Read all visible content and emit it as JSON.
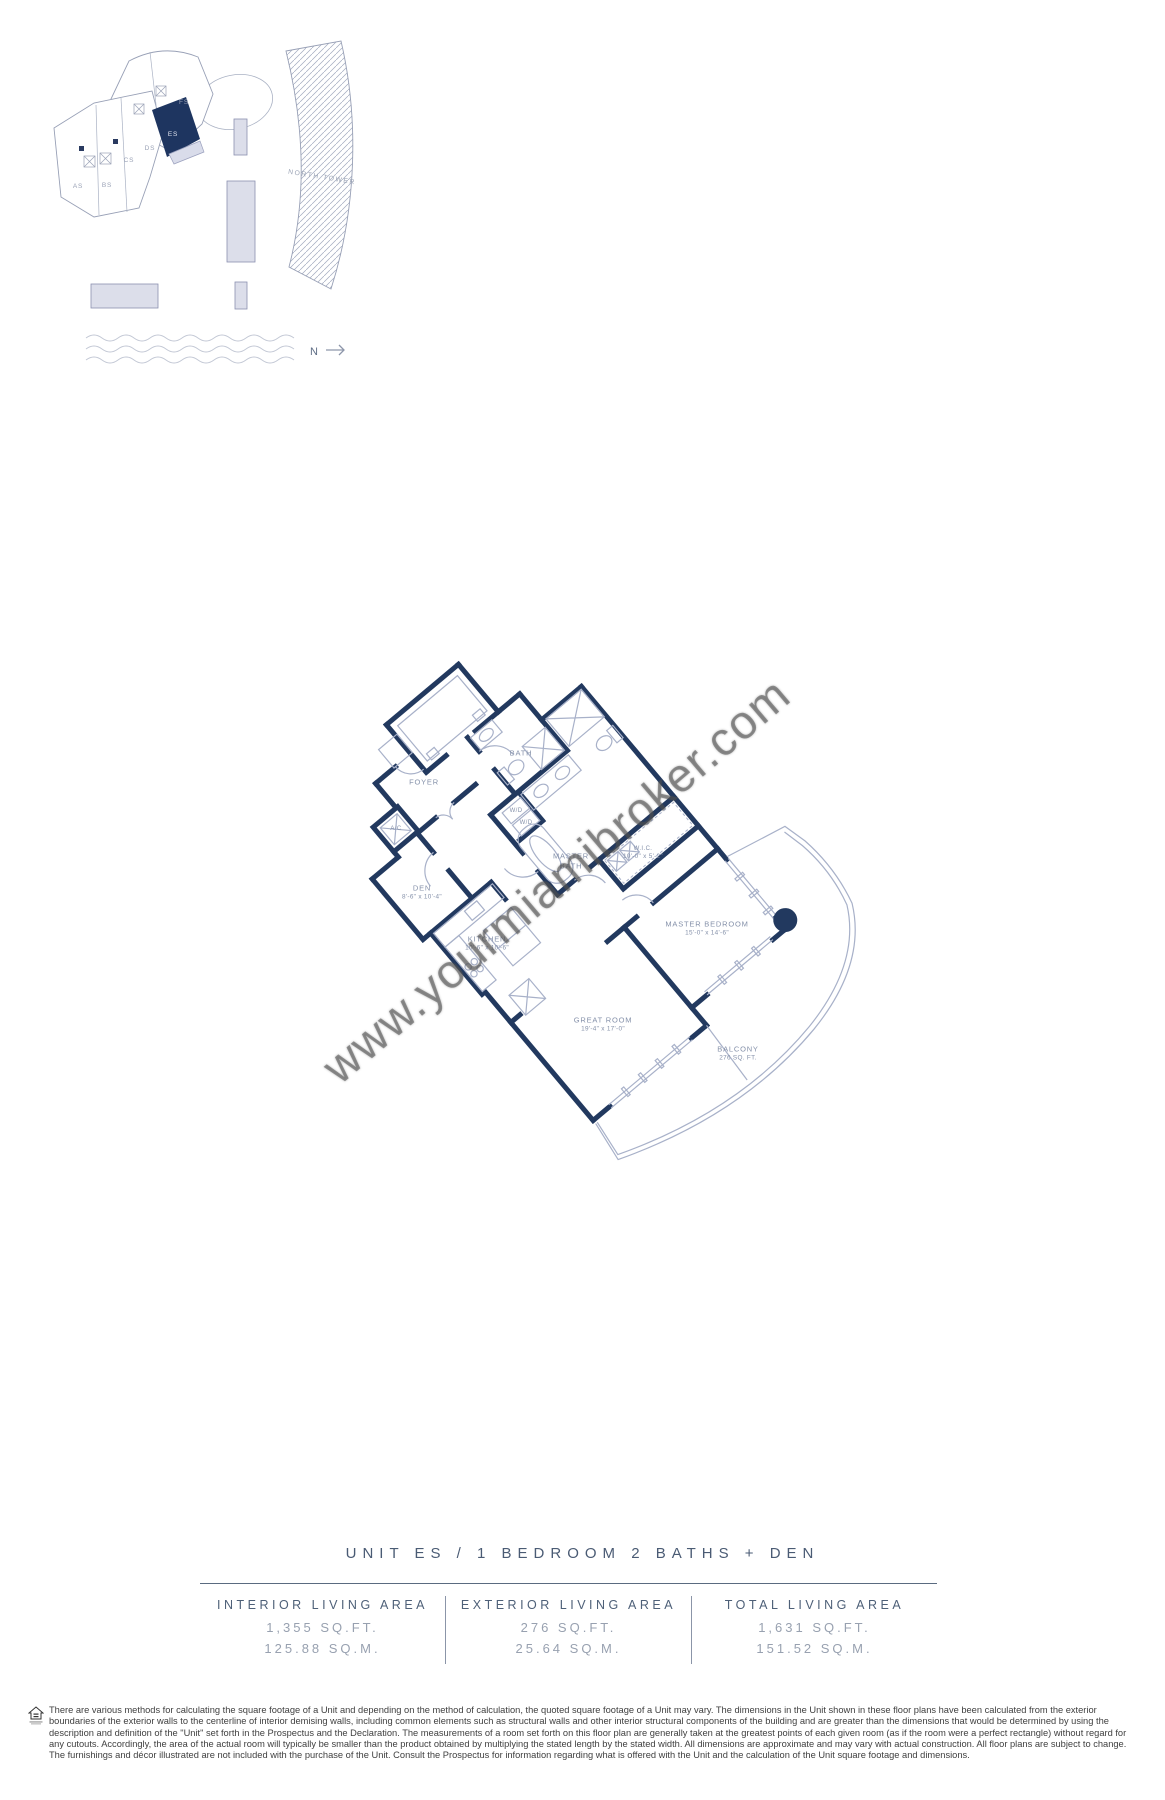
{
  "colors": {
    "wall_navy": "#22395f",
    "highlight_unit_fill": "#1e3560",
    "thin_line": "#a8b1c9",
    "lavender_fill": "#dcdeea",
    "label_gray_blue": "#8490a9",
    "title_color": "#4a5b74",
    "stats_value_color": "#98a1b0"
  },
  "site_plan": {
    "north_tower_label": "NORTH TOWER",
    "north_label": "N",
    "units": [
      {
        "id": "AS"
      },
      {
        "id": "BS"
      },
      {
        "id": "CS"
      },
      {
        "id": "DS"
      },
      {
        "id": "ES",
        "highlighted": true
      },
      {
        "id": "FS"
      }
    ]
  },
  "floor_plan": {
    "labels": [
      {
        "name": "FOYER",
        "dims": ""
      },
      {
        "name": "A/C",
        "dims": ""
      },
      {
        "name": "BATH",
        "dims": ""
      },
      {
        "name": "W/D",
        "dims": ""
      },
      {
        "name": "W/D",
        "dims": ""
      },
      {
        "name": "MASTER BATH",
        "dims": ""
      },
      {
        "name": "W.I.C.",
        "dims": "10'-0\" x 5'-2\""
      },
      {
        "name": "DEN",
        "dims": "8'-6\" x 10'-4\""
      },
      {
        "name": "KITCHEN",
        "dims": "10'-6\" x 10'-6\""
      },
      {
        "name": "MASTER BEDROOM",
        "dims": "15'-0\" x 14'-6\""
      },
      {
        "name": "GREAT ROOM",
        "dims": "19'-4\" x 17'-0\""
      },
      {
        "name": "BALCONY",
        "dims": "276 SQ. FT."
      }
    ]
  },
  "watermark": "www.yourmiamibroker.com",
  "title": "UNIT ES / 1 BEDROOM 2 BATHS + DEN",
  "stats": [
    {
      "label": "INTERIOR LIVING AREA",
      "sqft": "1,355 SQ.FT.",
      "sqm": "125.88 SQ.M."
    },
    {
      "label": "EXTERIOR LIVING AREA",
      "sqft": "276 SQ.FT.",
      "sqm": "25.64 SQ.M."
    },
    {
      "label": "TOTAL LIVING AREA",
      "sqft": "1,631 SQ.FT.",
      "sqm": "151.52 SQ.M."
    }
  ],
  "disclaimer": "There are various methods for calculating the square footage of a Unit and depending on the method of calculation, the quoted square footage of a Unit may vary.  The dimensions in the Unit shown in these floor plans have been calculated from the exterior boundaries of the exterior walls to the centerline of interior demising walls, including common elements such as structural walls and other interior structural components of the building and are greater than the dimensions that would be determined by using the description and definition of the \"Unit\" set forth in the Prospectus and the Declaration.  The measurements of a room set forth on this floor plan are generally taken at the greatest points of each given room (as if the room were a perfect rectangle) without regard for any cutouts.  Accordingly, the area of the actual room will typically be smaller than the product obtained by multiplying the stated length by the stated width.  All dimensions are approximate and may vary with actual construction. All floor plans are subject to change.  The furnishings and décor illustrated are not included with the purchase of the Unit.  Consult the Prospectus for information regarding what is offered with the Unit and the calculation of the Unit square footage and dimensions."
}
